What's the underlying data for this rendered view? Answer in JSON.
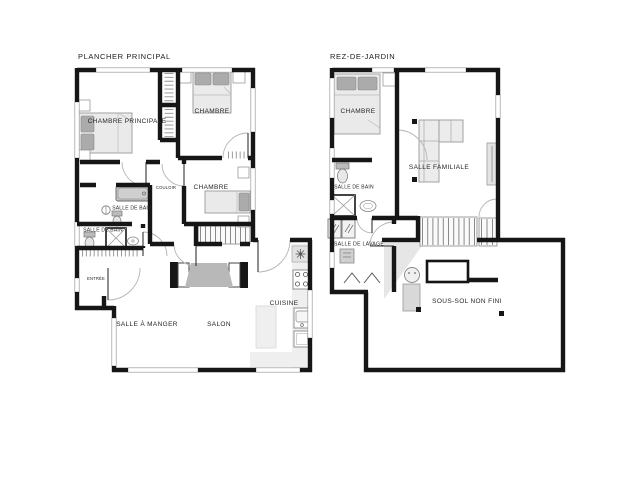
{
  "page": {
    "background": "#ffffff"
  },
  "colors": {
    "wall": "#161616",
    "furniture_fill": "#eaeaea",
    "furniture_stroke": "#999999",
    "pillow": "#ababab",
    "tub": "#c4c4c4",
    "label": "#262626"
  },
  "plans": [
    {
      "title": "PLANCHER PRINCIPAL",
      "rooms": {
        "chambre_principale": "CHAMBRE PRINCIPALE",
        "chambre_top": "CHAMBRE",
        "chambre_middle": "CHAMBRE",
        "couloir": "COULOIR",
        "salle_de_bain_haut": "SALLE DE BAIN",
        "salle_de_bain_bas": "SALLE DE BAIN",
        "entree": "ENTRÉE",
        "salle_a_manger": "SALLE À MANGER",
        "salon": "SALON",
        "cuisine": "CUISINE"
      }
    },
    {
      "title": "REZ-DE-JARDIN",
      "rooms": {
        "chambre": "CHAMBRE",
        "salle_familiale": "SALLE FAMILIALE",
        "salle_de_bain": "SALLE DE BAIN",
        "salle_de_lavage": "SALLE DE LAVAGE",
        "sous_sol": "SOUS-SOL NON FINI"
      }
    }
  ]
}
